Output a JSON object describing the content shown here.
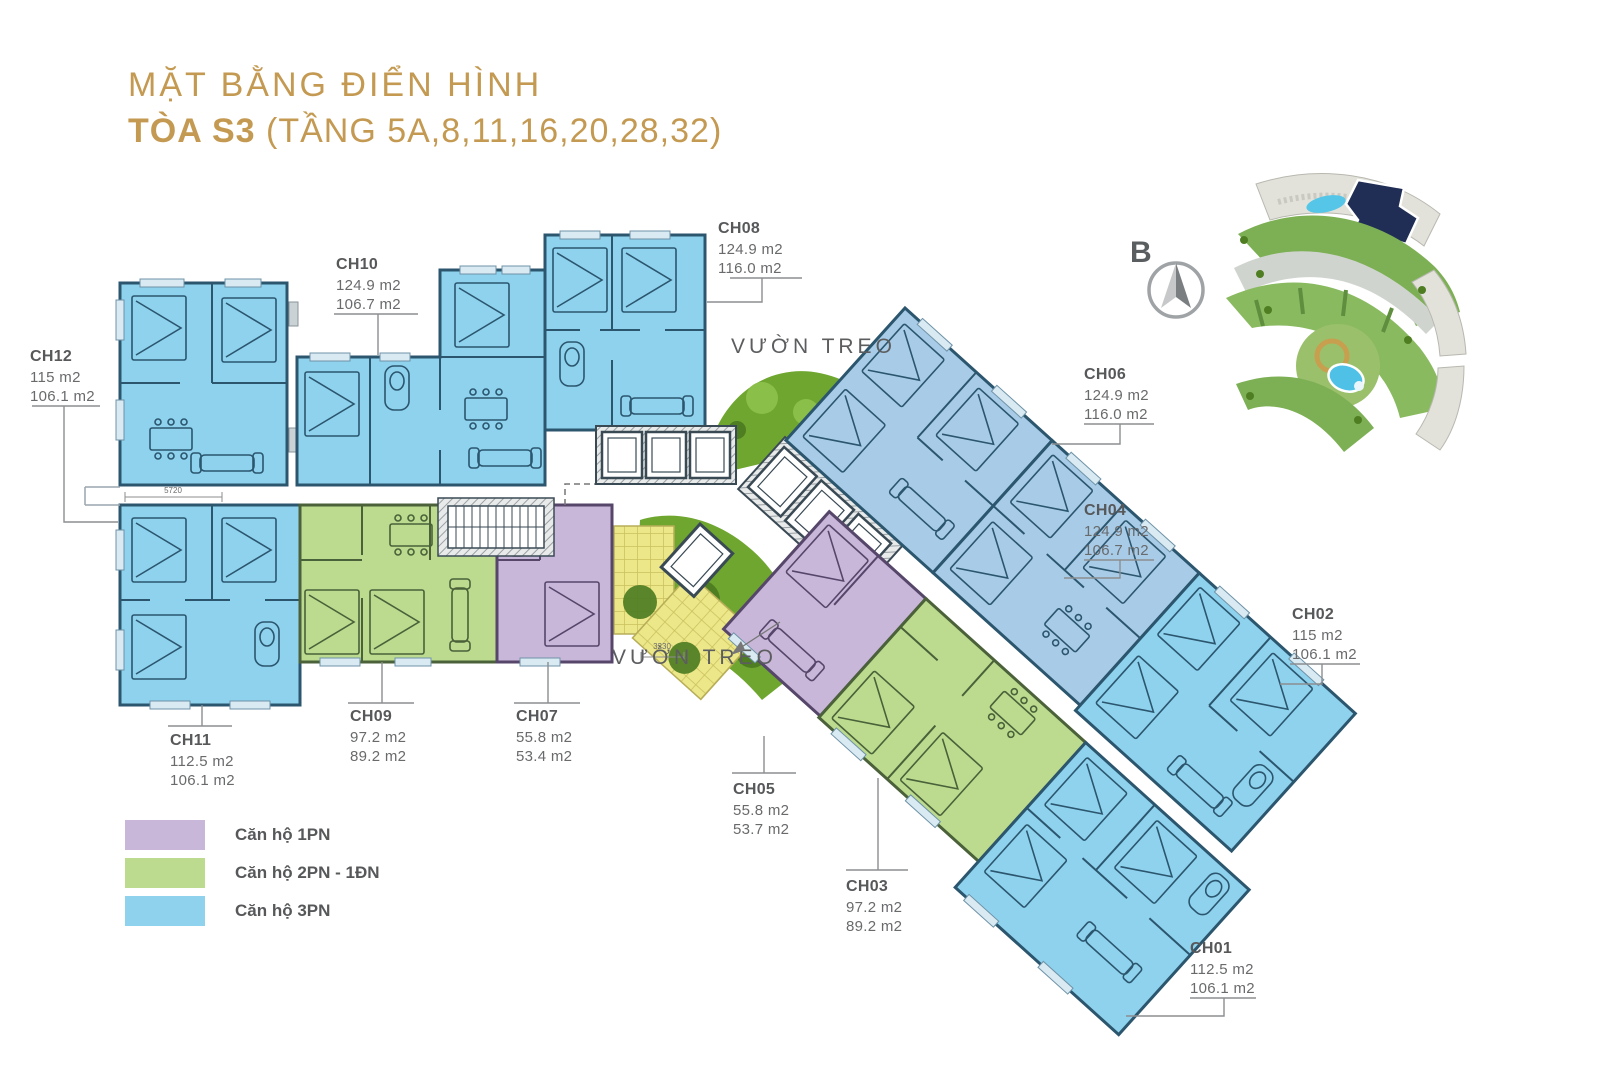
{
  "title": {
    "line1": "MẶT BẰNG ĐIỂN HÌNH",
    "building": "TÒA S3",
    "floors": " (TẦNG 5A,8,11,16,20,28,32)"
  },
  "compass": {
    "north_label": "B"
  },
  "garden": {
    "top_label": "VƯỜN TREO",
    "bottom_label": "VƯỜN TREO"
  },
  "dimensions": {
    "corridor_width": "5720",
    "garden_width": "3230"
  },
  "units": [
    {
      "id": "CH01",
      "area1": "112.5 m2",
      "area2": "106.1 m2",
      "type": "3PN"
    },
    {
      "id": "CH02",
      "area1": "115 m2",
      "area2": "106.1 m2",
      "type": "3PN"
    },
    {
      "id": "CH03",
      "area1": "97.2 m2",
      "area2": "89.2 m2",
      "type": "2PN-1ĐN"
    },
    {
      "id": "CH04",
      "area1": "124.9 m2",
      "area2": "106.7 m2",
      "type": "3PN"
    },
    {
      "id": "CH05",
      "area1": "55.8 m2",
      "area2": "53.7 m2",
      "type": "1PN"
    },
    {
      "id": "CH06",
      "area1": "124.9 m2",
      "area2": "116.0 m2",
      "type": "3PN"
    },
    {
      "id": "CH07",
      "area1": "55.8 m2",
      "area2": "53.4 m2",
      "type": "1PN"
    },
    {
      "id": "CH08",
      "area1": "124.9 m2",
      "area2": "116.0 m2",
      "type": "3PN"
    },
    {
      "id": "CH09",
      "area1": "97.2 m2",
      "area2": "89.2 m2",
      "type": "2PN-1ĐN"
    },
    {
      "id": "CH10",
      "area1": "124.9 m2",
      "area2": "106.7 m2",
      "type": "3PN"
    },
    {
      "id": "CH11",
      "area1": "112.5 m2",
      "area2": "106.1 m2",
      "type": "3PN"
    },
    {
      "id": "CH12",
      "area1": "115 m2",
      "area2": "106.1 m2",
      "type": "3PN"
    }
  ],
  "legend": {
    "items": [
      {
        "label": "Căn hộ 1PN",
        "color": "#C9B7D9"
      },
      {
        "label": "Căn hộ 2PN - 1ĐN",
        "color": "#BCDB8F"
      },
      {
        "label": "Căn hộ 3PN",
        "color": "#8FD2EE"
      }
    ]
  },
  "colors": {
    "accent_gold": "#C49A52",
    "unit_blue": "#8FD2EE",
    "unit_blue_muted": "#A8CCE8",
    "unit_green": "#BCDB8F",
    "unit_purple": "#C9B7D9",
    "garden_green": "#6FA62F",
    "patio_yellow": "#ECE789",
    "site_highlight_navy": "#202E55",
    "text_dark": "#57585A"
  }
}
